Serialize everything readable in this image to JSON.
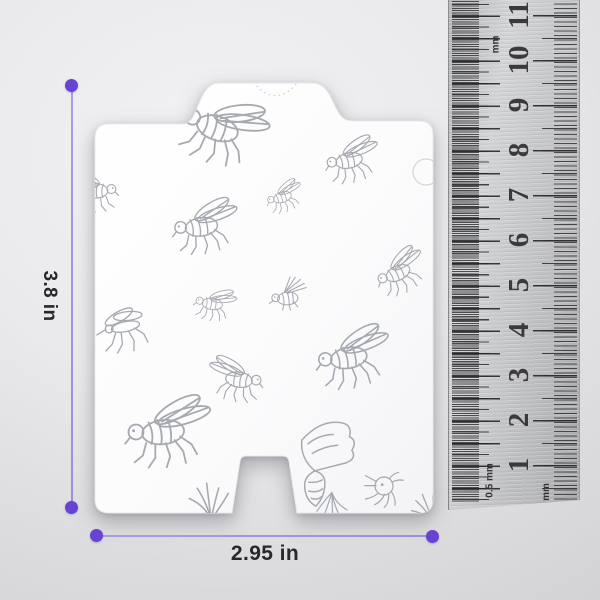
{
  "dimensions": {
    "height": {
      "label": "3.8 in"
    },
    "width": {
      "label": "2.95 in"
    }
  },
  "ruler": {
    "scale_numbers": [
      "1",
      "2",
      "3",
      "4",
      "5",
      "6",
      "7",
      "8",
      "9",
      "10",
      "11"
    ],
    "labels": {
      "top_left": "mm",
      "bottom_left": "0.5 mm",
      "bottom_right": "mm"
    }
  },
  "colors": {
    "accent_purple": "#6643d1",
    "dim_line_purple": "#9a8ede",
    "label_text": "#28282b",
    "sketch_gray": "#9da0a8",
    "ruler_number": "#3a3a3d"
  }
}
